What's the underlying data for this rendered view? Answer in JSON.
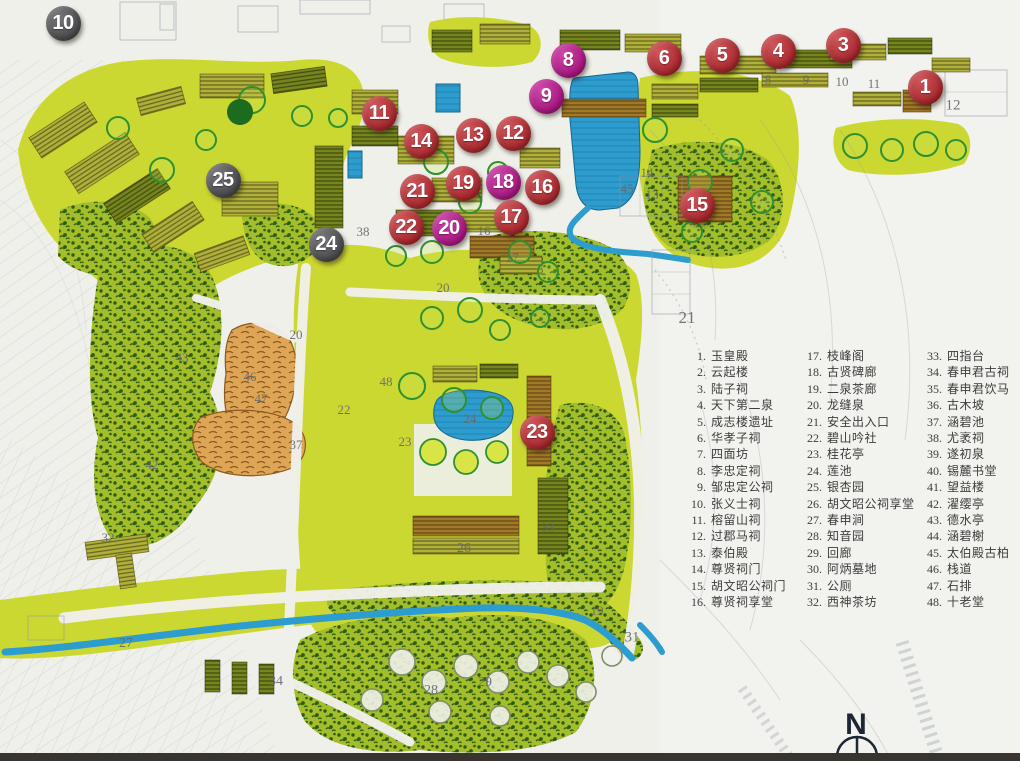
{
  "compass": {
    "label": "N"
  },
  "colors": {
    "marker_red": "#c1282e",
    "marker_magenta": "#c01391",
    "marker_gray": "#515254",
    "water": "#2d9cce",
    "water_line": "#16688f",
    "vegetation": "#ccd832",
    "vegetation_dark": "#a3bd2b",
    "canopy_mark": "#2d5c12",
    "tree_ring": "#2f9030",
    "roof_olive": "#b0b13b",
    "roof_brown": "#a07a28",
    "roof_dark": "#77851f",
    "rock": "#dfa557",
    "rock_stroke": "#8a5a1e",
    "paper": "#eff0ea",
    "pencil": "#8e97a3",
    "label_ink": "#63686e",
    "legend_ink": "#3c3c3c",
    "compass_ink": "#1c2733"
  },
  "markers": [
    {
      "num": "10",
      "color": "gray",
      "x": 63,
      "y": 23
    },
    {
      "num": "8",
      "color": "magenta",
      "x": 568,
      "y": 60
    },
    {
      "num": "9",
      "color": "magenta",
      "x": 546,
      "y": 96
    },
    {
      "num": "6",
      "color": "red",
      "x": 664,
      "y": 58
    },
    {
      "num": "5",
      "color": "red",
      "x": 722,
      "y": 55
    },
    {
      "num": "4",
      "color": "red",
      "x": 778,
      "y": 51
    },
    {
      "num": "3",
      "color": "red",
      "x": 843,
      "y": 45
    },
    {
      "num": "1",
      "color": "red",
      "x": 925,
      "y": 87
    },
    {
      "num": "11",
      "color": "red",
      "x": 379,
      "y": 113
    },
    {
      "num": "14",
      "color": "red",
      "x": 421,
      "y": 141
    },
    {
      "num": "13",
      "color": "red",
      "x": 473,
      "y": 135
    },
    {
      "num": "12",
      "color": "red",
      "x": 513,
      "y": 133
    },
    {
      "num": "21",
      "color": "red",
      "x": 417,
      "y": 191
    },
    {
      "num": "19",
      "color": "red",
      "x": 463,
      "y": 183
    },
    {
      "num": "18",
      "color": "magenta",
      "x": 503,
      "y": 182
    },
    {
      "num": "16",
      "color": "red",
      "x": 542,
      "y": 187
    },
    {
      "num": "22",
      "color": "red",
      "x": 406,
      "y": 227
    },
    {
      "num": "20",
      "color": "magenta",
      "x": 449,
      "y": 228
    },
    {
      "num": "17",
      "color": "red",
      "x": 511,
      "y": 217
    },
    {
      "num": "15",
      "color": "red",
      "x": 697,
      "y": 205
    },
    {
      "num": "25",
      "color": "gray",
      "x": 223,
      "y": 180
    },
    {
      "num": "24",
      "color": "gray",
      "x": 326,
      "y": 244
    },
    {
      "num": "23",
      "color": "red",
      "x": 537,
      "y": 432
    }
  ],
  "map_labels": [
    {
      "text": "8",
      "x": 768,
      "y": 80
    },
    {
      "text": "9",
      "x": 806,
      "y": 80
    },
    {
      "text": "10",
      "x": 842,
      "y": 82
    },
    {
      "text": "11",
      "x": 874,
      "y": 84
    },
    {
      "text": "12",
      "x": 953,
      "y": 106,
      "size": 15
    },
    {
      "text": "14",
      "x": 647,
      "y": 173
    },
    {
      "text": "45",
      "x": 627,
      "y": 189
    },
    {
      "text": "13",
      "x": 652,
      "y": 195
    },
    {
      "text": "38",
      "x": 363,
      "y": 232
    },
    {
      "text": "16",
      "x": 484,
      "y": 231
    },
    {
      "text": "17",
      "x": 512,
      "y": 258
    },
    {
      "text": "20",
      "x": 443,
      "y": 288
    },
    {
      "text": "21",
      "x": 687,
      "y": 318,
      "size": 17
    },
    {
      "text": "20",
      "x": 296,
      "y": 335
    },
    {
      "text": "43",
      "x": 182,
      "y": 358
    },
    {
      "text": "46",
      "x": 250,
      "y": 377
    },
    {
      "text": "48",
      "x": 386,
      "y": 382
    },
    {
      "text": "47",
      "x": 261,
      "y": 399
    },
    {
      "text": "22",
      "x": 344,
      "y": 410
    },
    {
      "text": "24",
      "x": 470,
      "y": 419
    },
    {
      "text": "23",
      "x": 405,
      "y": 442
    },
    {
      "text": "37",
      "x": 296,
      "y": 445
    },
    {
      "text": "42",
      "x": 152,
      "y": 465
    },
    {
      "text": "33",
      "x": 548,
      "y": 528
    },
    {
      "text": "32",
      "x": 108,
      "y": 538
    },
    {
      "text": "26",
      "x": 464,
      "y": 549,
      "size": 14
    },
    {
      "text": "19",
      "x": 597,
      "y": 611
    },
    {
      "text": "31",
      "x": 632,
      "y": 638,
      "size": 15
    },
    {
      "text": "27",
      "x": 126,
      "y": 644,
      "size": 14
    },
    {
      "text": "34",
      "x": 276,
      "y": 682,
      "size": 14
    },
    {
      "text": "28",
      "x": 431,
      "y": 691,
      "size": 14
    },
    {
      "text": "29",
      "x": 485,
      "y": 683,
      "size": 14
    }
  ],
  "legend": {
    "columns": [
      {
        "items": [
          {
            "num": "1",
            "label": "玉皇殿"
          },
          {
            "num": "2",
            "label": "云起楼"
          },
          {
            "num": "3",
            "label": "陆子祠"
          },
          {
            "num": "4",
            "label": "天下第二泉"
          },
          {
            "num": "5",
            "label": "成志楼遗址"
          },
          {
            "num": "6",
            "label": "华孝子祠"
          },
          {
            "num": "7",
            "label": "四面坊"
          },
          {
            "num": "8",
            "label": "李忠定祠"
          },
          {
            "num": "9",
            "label": "邹忠定公祠"
          },
          {
            "num": "10",
            "label": "张义士祠"
          },
          {
            "num": "11",
            "label": "榕留山祠"
          },
          {
            "num": "12",
            "label": "过郡马祠"
          },
          {
            "num": "13",
            "label": "泰伯殿"
          },
          {
            "num": "14",
            "label": "尊贤祠门"
          },
          {
            "num": "15",
            "label": "胡文昭公祠门"
          },
          {
            "num": "16",
            "label": "尊贤祠享堂"
          }
        ]
      },
      {
        "items": [
          {
            "num": "17",
            "label": "枝峰阁"
          },
          {
            "num": "18",
            "label": "古贤碑廊"
          },
          {
            "num": "19",
            "label": "二泉茶廊"
          },
          {
            "num": "20",
            "label": "龙缝泉"
          },
          {
            "num": "21",
            "label": "安全出入口"
          },
          {
            "num": "22",
            "label": "碧山吟社"
          },
          {
            "num": "23",
            "label": "桂花亭"
          },
          {
            "num": "24",
            "label": "莲池"
          },
          {
            "num": "25",
            "label": "银杏园"
          },
          {
            "num": "26",
            "label": "胡文昭公祠享堂"
          },
          {
            "num": "27",
            "label": "春申涧"
          },
          {
            "num": "28",
            "label": "知音园"
          },
          {
            "num": "29",
            "label": "回廊"
          },
          {
            "num": "30",
            "label": "阿炳墓地"
          },
          {
            "num": "31",
            "label": "公厕"
          },
          {
            "num": "32",
            "label": "西神茶坊"
          }
        ]
      },
      {
        "items": [
          {
            "num": "33",
            "label": "四指台"
          },
          {
            "num": "34",
            "label": "春申君古祠"
          },
          {
            "num": "35",
            "label": "春申君饮马"
          },
          {
            "num": "36",
            "label": "古木坡"
          },
          {
            "num": "37",
            "label": "涵碧池"
          },
          {
            "num": "38",
            "label": "尤袤祠"
          },
          {
            "num": "39",
            "label": "遂初泉"
          },
          {
            "num": "40",
            "label": "锡麓书堂"
          },
          {
            "num": "41",
            "label": "望益楼"
          },
          {
            "num": "42",
            "label": "濯缨亭"
          },
          {
            "num": "43",
            "label": "德水亭"
          },
          {
            "num": "44",
            "label": "涵碧榭"
          },
          {
            "num": "45",
            "label": "太伯殿古柏"
          },
          {
            "num": "46",
            "label": "栈道"
          },
          {
            "num": "47",
            "label": "石排"
          },
          {
            "num": "48",
            "label": "十老堂"
          }
        ]
      }
    ]
  }
}
